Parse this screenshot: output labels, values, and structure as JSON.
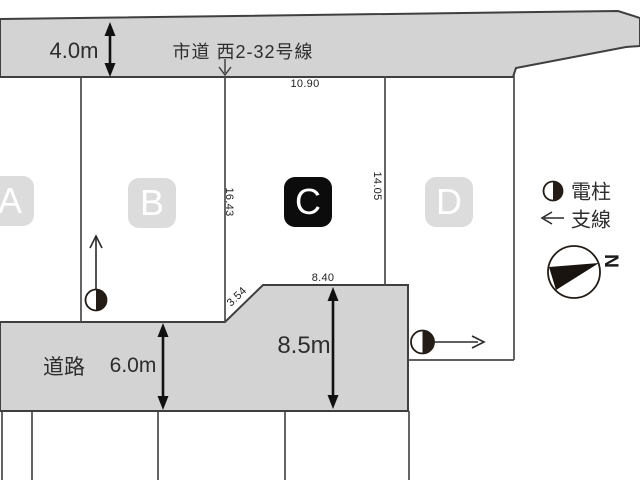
{
  "colors": {
    "road_fill": "#d3d3d3",
    "road_outline": "#3f3f3f",
    "parcel_line": "#4a4a4a",
    "lot_badge_bg": "#dcdcdc",
    "lot_badge_highlight_bg": "#0c0c0c",
    "lot_badge_text": "#ffffff",
    "text": "#2d2d2d"
  },
  "roads": {
    "top": {
      "name": "市道 西2-32号線",
      "width_label": "4.0m"
    },
    "bottom": {
      "name": "道路",
      "width_label": "6.0m",
      "extension_width_label": "8.5m"
    }
  },
  "lots": [
    {
      "label": "A",
      "highlighted": false
    },
    {
      "label": "B",
      "highlighted": false
    },
    {
      "label": "C",
      "highlighted": true
    },
    {
      "label": "D",
      "highlighted": false
    }
  ],
  "dimensions": [
    "10.90",
    "16.43",
    "14.05",
    "3.54",
    "8.40"
  ],
  "legend": {
    "pole_label": "電柱",
    "wire_label": "支線"
  },
  "compass": {
    "north_label": "N"
  }
}
